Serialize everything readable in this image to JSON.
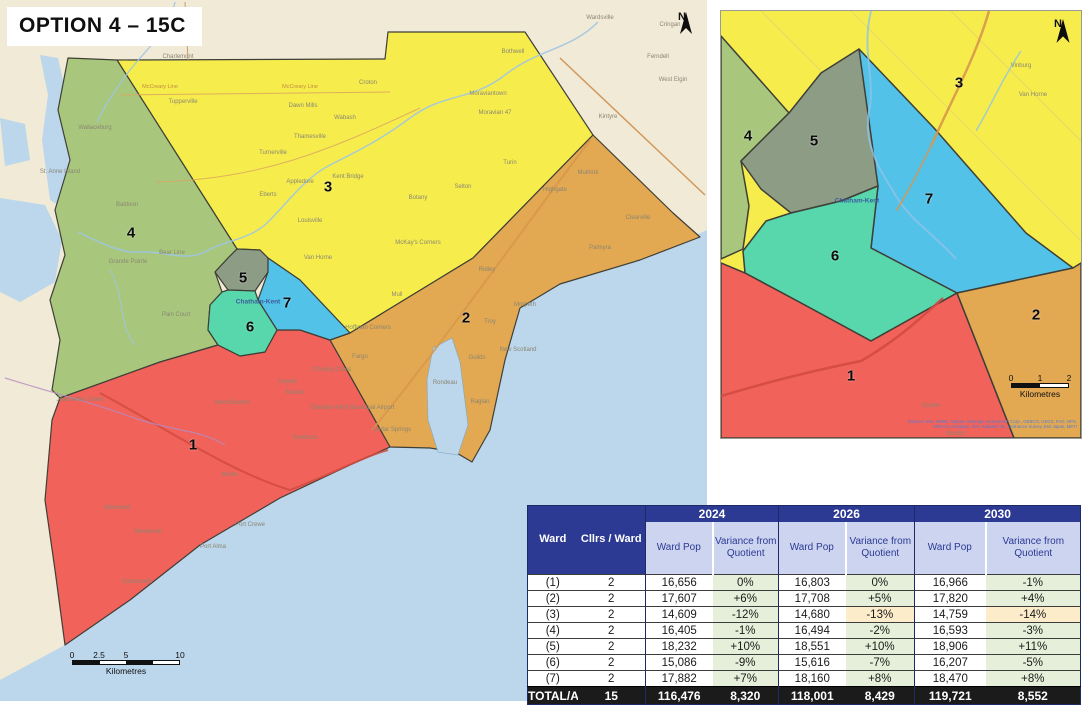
{
  "title": "OPTION 4 – 15C",
  "colors": {
    "w1": "#f0625a",
    "w2": "#e2a852",
    "w3": "#f6ed4d",
    "w4": "#a8c77d",
    "w5": "#8d9c85",
    "w6": "#57d7ab",
    "w7": "#52c2e8",
    "water": "#bcd6eb",
    "land": "#f0ead7",
    "boundary": "#3f3f37",
    "table_header": "#2c3a94",
    "table_subheader": "#ccd4f0",
    "variance_green": "#e6efd9",
    "variance_orange": "#fcecca",
    "total_row": "#1b1b1b"
  },
  "main_map": {
    "north_label": "N",
    "city_label": {
      "text": "Chatham-Kent",
      "x": 258,
      "y": 302
    },
    "ward_labels": [
      {
        "n": "1",
        "x": 193,
        "y": 445
      },
      {
        "n": "2",
        "x": 466,
        "y": 318
      },
      {
        "n": "3",
        "x": 328,
        "y": 187
      },
      {
        "n": "4",
        "x": 131,
        "y": 233
      },
      {
        "n": "5",
        "x": 243,
        "y": 278
      },
      {
        "n": "6",
        "x": 250,
        "y": 327
      },
      {
        "n": "7",
        "x": 287,
        "y": 303
      }
    ],
    "place_labels": [
      {
        "t": "Wallaceburg",
        "x": 95,
        "y": 128
      },
      {
        "t": "Charlemont",
        "x": 178,
        "y": 57
      },
      {
        "t": "Tupperville",
        "x": 183,
        "y": 102
      },
      {
        "t": "Dawn Mills",
        "x": 303,
        "y": 106
      },
      {
        "t": "Croton",
        "x": 368,
        "y": 83
      },
      {
        "t": "Wabash",
        "x": 345,
        "y": 118
      },
      {
        "t": "Thamesville",
        "x": 310,
        "y": 137
      },
      {
        "t": "Turnerville",
        "x": 273,
        "y": 153
      },
      {
        "t": "Appledore",
        "x": 300,
        "y": 182
      },
      {
        "t": "Kent Bridge",
        "x": 348,
        "y": 177
      },
      {
        "t": "Eberts",
        "x": 268,
        "y": 195
      },
      {
        "t": "Louisville",
        "x": 310,
        "y": 221
      },
      {
        "t": "Van Horne",
        "x": 318,
        "y": 258
      },
      {
        "t": "Baldoon",
        "x": 127,
        "y": 205
      },
      {
        "t": "Bear Line",
        "x": 172,
        "y": 253
      },
      {
        "t": "Grande Pointe",
        "x": 128,
        "y": 262
      },
      {
        "t": "Pain Court",
        "x": 176,
        "y": 315
      },
      {
        "t": "St. Anne Island",
        "x": 60,
        "y": 172
      },
      {
        "t": "Jeannettes Creek",
        "x": 80,
        "y": 400
      },
      {
        "t": "North Buxton",
        "x": 232,
        "y": 403
      },
      {
        "t": "Doyles",
        "x": 288,
        "y": 382
      },
      {
        "t": "Buxton",
        "x": 295,
        "y": 393
      },
      {
        "t": "Merlin",
        "x": 230,
        "y": 475
      },
      {
        "t": "Glenwood",
        "x": 117,
        "y": 508
      },
      {
        "t": "Stevenson",
        "x": 148,
        "y": 532
      },
      {
        "t": "Port Crewe",
        "x": 250,
        "y": 525
      },
      {
        "t": "Port Alma",
        "x": 213,
        "y": 547
      },
      {
        "t": "Coatsworth",
        "x": 137,
        "y": 582
      },
      {
        "t": "Sandison",
        "x": 305,
        "y": 438
      },
      {
        "t": "Cedar Springs",
        "x": 392,
        "y": 430
      },
      {
        "t": "Charing Cross",
        "x": 332,
        "y": 370
      },
      {
        "t": "Fargo",
        "x": 360,
        "y": 357
      },
      {
        "t": "Hoffman Corners",
        "x": 368,
        "y": 328
      },
      {
        "t": "Mull",
        "x": 397,
        "y": 295
      },
      {
        "t": "Troy",
        "x": 490,
        "y": 322
      },
      {
        "t": "Guilds",
        "x": 477,
        "y": 358
      },
      {
        "t": "Rondeau",
        "x": 445,
        "y": 383
      },
      {
        "t": "Raglan",
        "x": 480,
        "y": 402
      },
      {
        "t": "New Scotland",
        "x": 518,
        "y": 350
      },
      {
        "t": "Morpeth",
        "x": 525,
        "y": 305
      },
      {
        "t": "Ridley",
        "x": 487,
        "y": 270
      },
      {
        "t": "Muirkirk",
        "x": 588,
        "y": 173
      },
      {
        "t": "Highgate",
        "x": 555,
        "y": 190
      },
      {
        "t": "Clearville",
        "x": 638,
        "y": 218
      },
      {
        "t": "Palmyra",
        "x": 600,
        "y": 248
      },
      {
        "t": "Turin",
        "x": 510,
        "y": 163
      },
      {
        "t": "Selton",
        "x": 463,
        "y": 187
      },
      {
        "t": "Botany",
        "x": 418,
        "y": 198
      },
      {
        "t": "McKay's Corners",
        "x": 418,
        "y": 243
      },
      {
        "t": "Moraviantown",
        "x": 488,
        "y": 94
      },
      {
        "t": "Moravian 47",
        "x": 495,
        "y": 113
      },
      {
        "t": "Bothwell",
        "x": 513,
        "y": 52
      },
      {
        "t": "Wardsville",
        "x": 600,
        "y": 18
      },
      {
        "t": "Cringan",
        "x": 670,
        "y": 25
      },
      {
        "t": "Ferndell",
        "x": 658,
        "y": 57
      },
      {
        "t": "West Elgin",
        "x": 673,
        "y": 80
      },
      {
        "t": "Kintyre",
        "x": 608,
        "y": 117
      },
      {
        "t": "Chatham-Kent Municipal Airport",
        "x": 352,
        "y": 408
      }
    ],
    "road_labels": [
      {
        "t": "McCreary Line",
        "x": 160,
        "y": 88
      },
      {
        "t": "McCreary Line",
        "x": 300,
        "y": 88
      }
    ],
    "scale_bar": {
      "ticks": [
        "0",
        "2.5",
        "5",
        "10"
      ],
      "unit": "Kilometres"
    }
  },
  "inset_map": {
    "north_label": "N",
    "city_label": {
      "text": "Chatham-Kent",
      "x": 136,
      "y": 190
    },
    "ward_labels": [
      {
        "n": "1",
        "x": 130,
        "y": 365
      },
      {
        "n": "2",
        "x": 315,
        "y": 304
      },
      {
        "n": "3",
        "x": 238,
        "y": 72
      },
      {
        "n": "4",
        "x": 27,
        "y": 125
      },
      {
        "n": "5",
        "x": 93,
        "y": 130
      },
      {
        "n": "6",
        "x": 114,
        "y": 245
      },
      {
        "n": "7",
        "x": 208,
        "y": 188
      }
    ],
    "place_labels": [
      {
        "t": "Van Horne",
        "x": 312,
        "y": 84
      },
      {
        "t": "Vinburg",
        "x": 300,
        "y": 55
      },
      {
        "t": "Doyles",
        "x": 210,
        "y": 395
      },
      {
        "t": "Buxton",
        "x": 235,
        "y": 423
      }
    ],
    "scale_bar": {
      "ticks": [
        "0",
        "1",
        "2"
      ],
      "unit": "Kilometres"
    },
    "credits": [
      "Sources: Esri, HERE, Garmin, Intermap, increment P Corp., GEBCO, USGS, FAO, NPS,",
      "NRCAN, GeoBase, IGN, Kadaster NL, Ordnance Survey, Esri Japan, METI"
    ]
  },
  "table": {
    "col1_header": "Ward",
    "col2_header": "Cllrs / Ward",
    "year_groups": [
      {
        "year": "2024",
        "sub": [
          "Ward Pop",
          "Variance from Quotient"
        ]
      },
      {
        "year": "2026",
        "sub": [
          "Ward Pop",
          "Variance from Quotient"
        ]
      },
      {
        "year": "2030",
        "sub": [
          "Ward Pop",
          "Variance from Quotient"
        ]
      }
    ],
    "rows": [
      {
        "ward": "(1)",
        "cllrs": "2",
        "cells": [
          {
            "v": "16,656"
          },
          {
            "v": "0%",
            "bg": "green"
          },
          {
            "v": "16,803"
          },
          {
            "v": "0%",
            "bg": "green"
          },
          {
            "v": "16,966"
          },
          {
            "v": "-1%",
            "bg": "green"
          }
        ]
      },
      {
        "ward": "(2)",
        "cllrs": "2",
        "cells": [
          {
            "v": "17,607"
          },
          {
            "v": "+6%",
            "bg": "green"
          },
          {
            "v": "17,708"
          },
          {
            "v": "+5%",
            "bg": "green"
          },
          {
            "v": "17,820"
          },
          {
            "v": "+4%",
            "bg": "green"
          }
        ]
      },
      {
        "ward": "(3)",
        "cllrs": "2",
        "cells": [
          {
            "v": "14,609"
          },
          {
            "v": "-12%",
            "bg": "green"
          },
          {
            "v": "14,680"
          },
          {
            "v": "-13%",
            "bg": "orange"
          },
          {
            "v": "14,759"
          },
          {
            "v": "-14%",
            "bg": "orange"
          }
        ]
      },
      {
        "ward": "(4)",
        "cllrs": "2",
        "cells": [
          {
            "v": "16,405"
          },
          {
            "v": "-1%",
            "bg": "green"
          },
          {
            "v": "16,494"
          },
          {
            "v": "-2%",
            "bg": "green"
          },
          {
            "v": "16,593"
          },
          {
            "v": "-3%",
            "bg": "green"
          }
        ]
      },
      {
        "ward": "(5)",
        "cllrs": "2",
        "cells": [
          {
            "v": "18,232"
          },
          {
            "v": "+10%",
            "bg": "green"
          },
          {
            "v": "18,551"
          },
          {
            "v": "+10%",
            "bg": "green"
          },
          {
            "v": "18,906"
          },
          {
            "v": "+11%",
            "bg": "green"
          }
        ]
      },
      {
        "ward": "(6)",
        "cllrs": "2",
        "cells": [
          {
            "v": "15,086"
          },
          {
            "v": "-9%",
            "bg": "green"
          },
          {
            "v": "15,616"
          },
          {
            "v": "-7%",
            "bg": "green"
          },
          {
            "v": "16,207"
          },
          {
            "v": "-5%",
            "bg": "green"
          }
        ]
      },
      {
        "ward": "(7)",
        "cllrs": "2",
        "cells": [
          {
            "v": "17,882"
          },
          {
            "v": "+7%",
            "bg": "green"
          },
          {
            "v": "18,160"
          },
          {
            "v": "+8%",
            "bg": "green"
          },
          {
            "v": "18,470"
          },
          {
            "v": "+8%",
            "bg": "green"
          }
        ]
      }
    ],
    "total": {
      "label": "TOTAL/AVG",
      "cllrs": "15",
      "cells": [
        "116,476",
        "8,320",
        "118,001",
        "8,429",
        "119,721",
        "8,552"
      ]
    }
  }
}
